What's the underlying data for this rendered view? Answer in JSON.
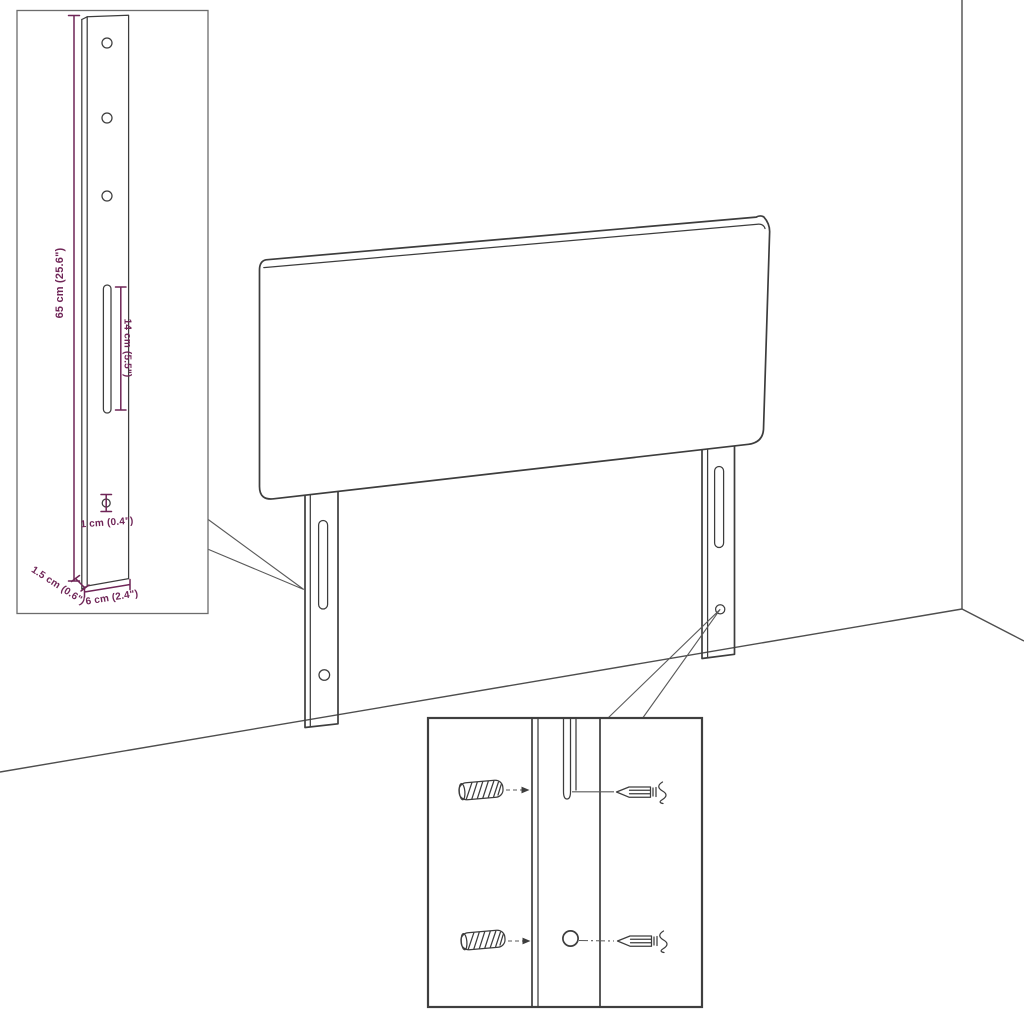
{
  "figure": {
    "title": "headboard-assembly-diagram",
    "background": "#ffffff",
    "line_color": "#3d3d3d",
    "dimension_color": "#6f2557"
  },
  "bracket_inset": {
    "labels": {
      "height": "65 cm (25.6\")",
      "slot": "14 cm (5.5\")",
      "hole": "1 cm (0.4\")",
      "thickness": "1.5 cm (0.6\")",
      "width": "6 cm (2.4\")"
    },
    "measurements": {
      "height_cm": 65,
      "height_in": 25.6,
      "slot_cm": 14,
      "slot_in": 5.5,
      "hole_cm": 1,
      "hole_in": 0.4,
      "thickness_cm": 1.5,
      "thickness_in": 0.6,
      "width_cm": 6,
      "width_in": 2.4
    }
  },
  "icons": [
    {
      "name": "wall-plug-icon",
      "shape": "hatched-cylinder",
      "count": 2
    },
    {
      "name": "screw-icon",
      "shape": "pointed-screw-with-thread",
      "count": 2
    }
  ]
}
